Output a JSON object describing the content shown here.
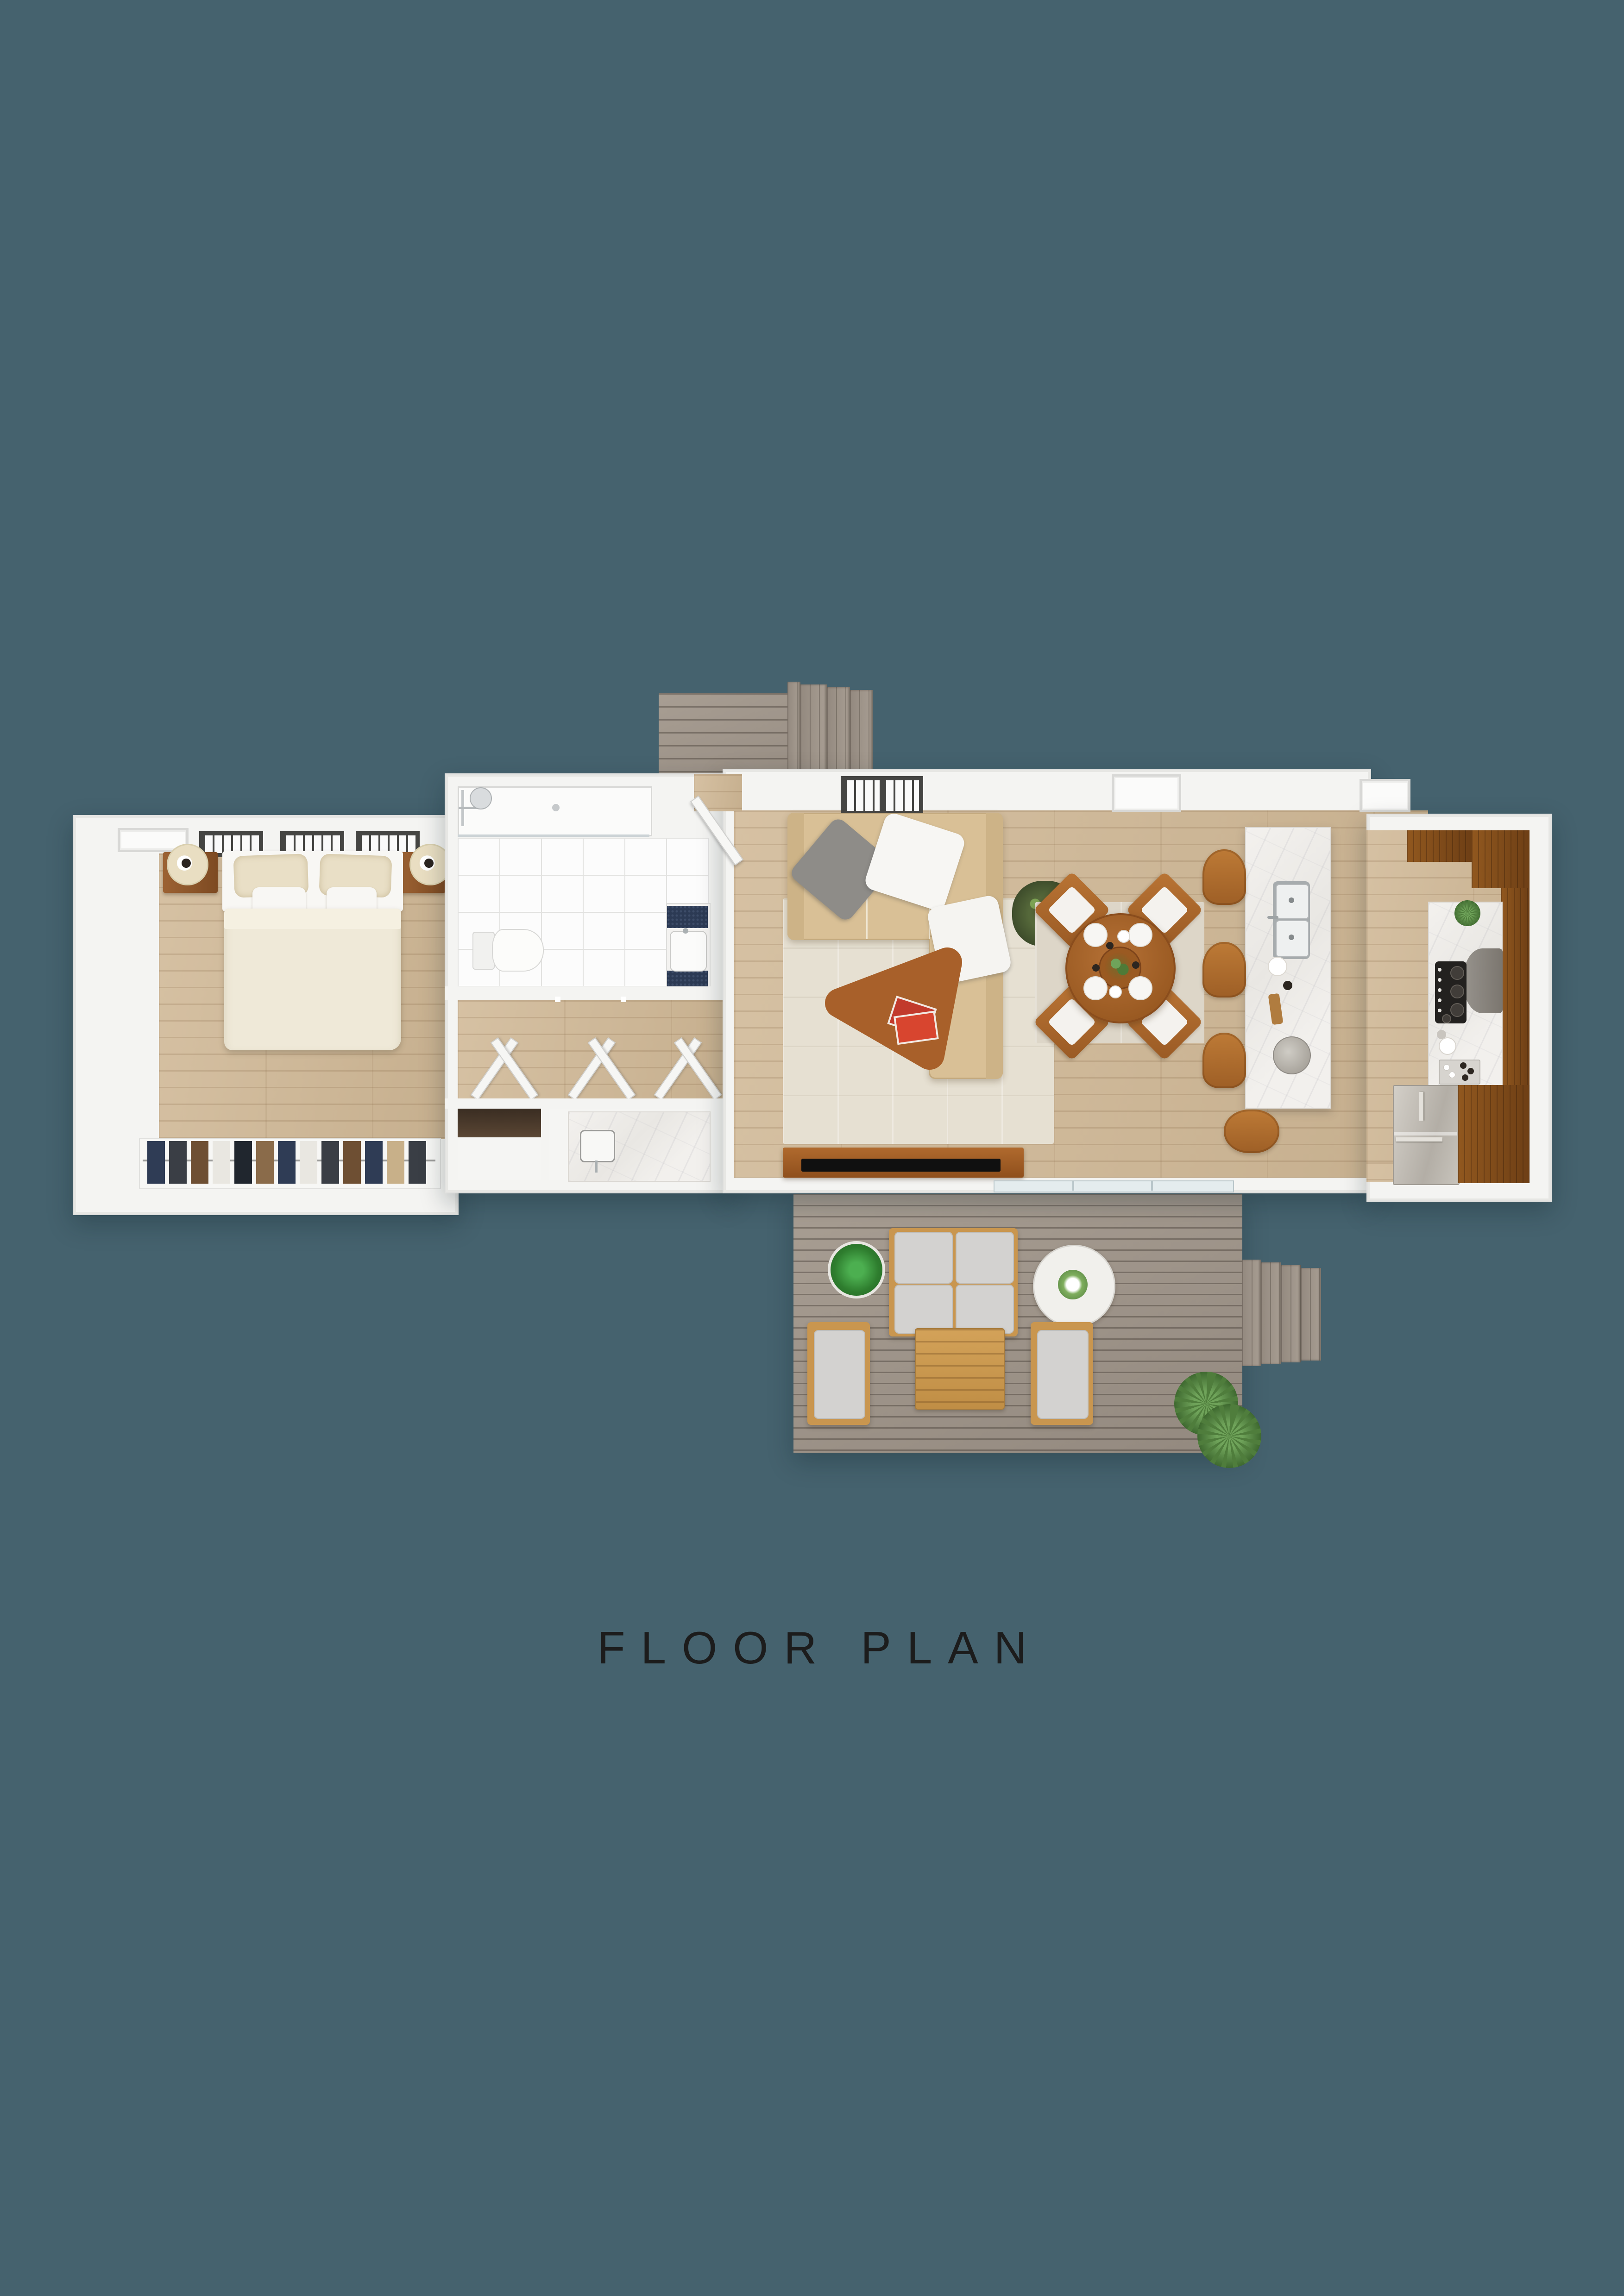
{
  "title": {
    "label": "FLOOR PLAN"
  },
  "palette": {
    "background": "#45626e",
    "ink": "#1c1c1c",
    "wall": "#f4f4f2",
    "wallEdge": "#e2e2e0",
    "floorLight": "#d6c1a3",
    "floorDark": "#c6af8e",
    "deckLight": "#a89e93",
    "deckDark": "#93897f",
    "counterWood": "#91581f",
    "counterWoodDark": "#6e3f15",
    "sofa": "#d9c096",
    "sofaEdge": "#c3a97e",
    "duvet": "#efe9d8",
    "pillow": "#e9dfc6",
    "whitefab": "#f8f7f4",
    "rug": "#e6e0d2",
    "dineRug": "#ddd6c8",
    "tableWood": "#a8602a",
    "tv": "#101010",
    "tvWood": "#a05f28",
    "outWood": "#c9964f",
    "outCushion": "#d3d2d0",
    "steel": "#c4bfb7",
    "tile": "#fcfcfc",
    "tileLine": "#e2e2e0",
    "glass": "#e4ecee",
    "mosaic": "#2c3a54",
    "lamp": "#e9dec2"
  }
}
